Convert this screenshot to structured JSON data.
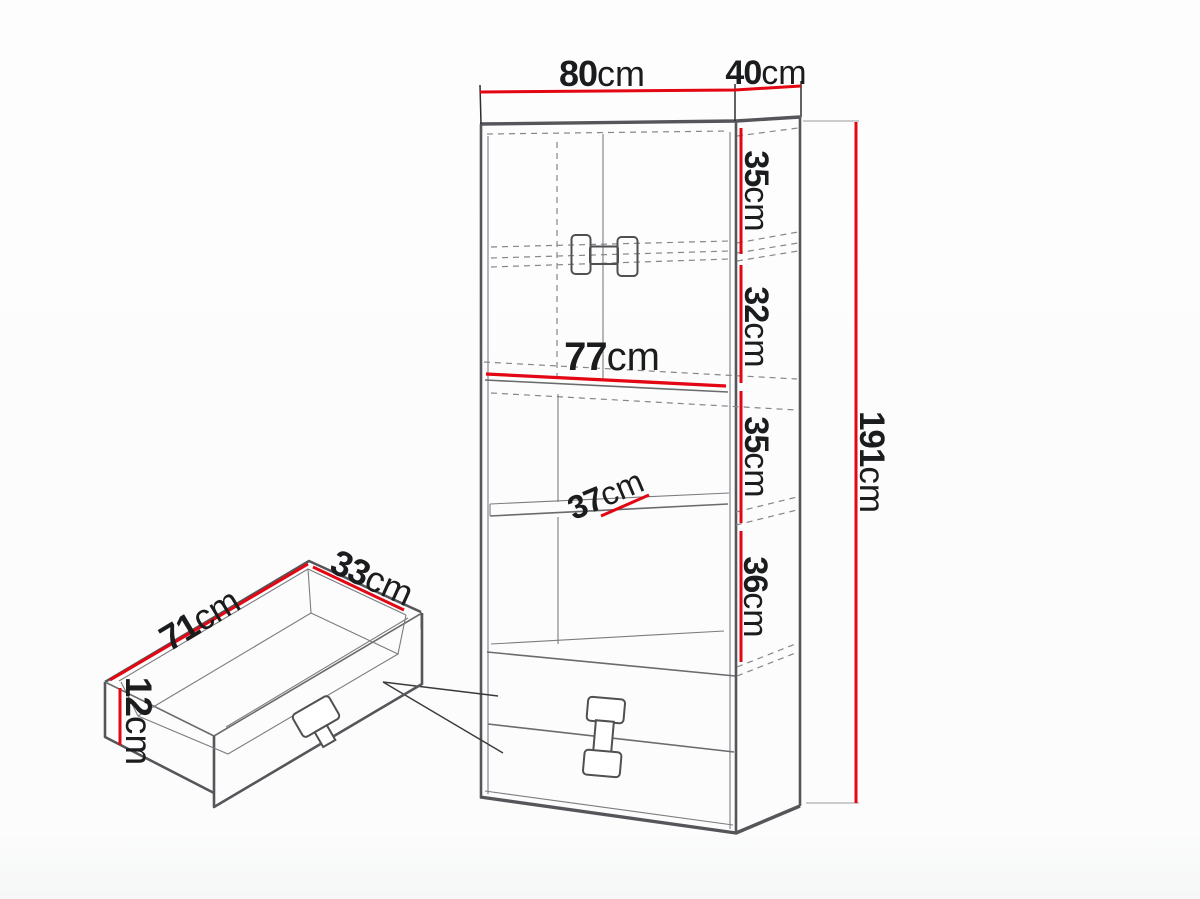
{
  "title": "Cabinet dimensions diagram",
  "colors": {
    "dimension_red": "#e30613",
    "line_dark": "#55565a",
    "line_mid": "#6a6b6d",
    "dash_gray": "#85868a",
    "text": "#1b1c1e",
    "background": "#fcfcfc"
  },
  "cabinet": {
    "width_label": {
      "value": "80",
      "unit": "cm"
    },
    "depth_label": {
      "value": "40",
      "unit": "cm"
    },
    "height_label": {
      "value": "191",
      "unit": "cm"
    },
    "inner_width_label": {
      "value": "77",
      "unit": "cm"
    },
    "shelf_depth_label": {
      "value": "37",
      "unit": "cm"
    },
    "section_labels": [
      {
        "value": "35",
        "unit": "cm"
      },
      {
        "value": "32",
        "unit": "cm"
      },
      {
        "value": "35",
        "unit": "cm"
      },
      {
        "value": "36",
        "unit": "cm"
      }
    ]
  },
  "drawer_detail": {
    "length_label": {
      "value": "71",
      "unit": "cm"
    },
    "depth_label": {
      "value": "33",
      "unit": "cm"
    },
    "height_label": {
      "value": "12",
      "unit": "cm"
    }
  }
}
